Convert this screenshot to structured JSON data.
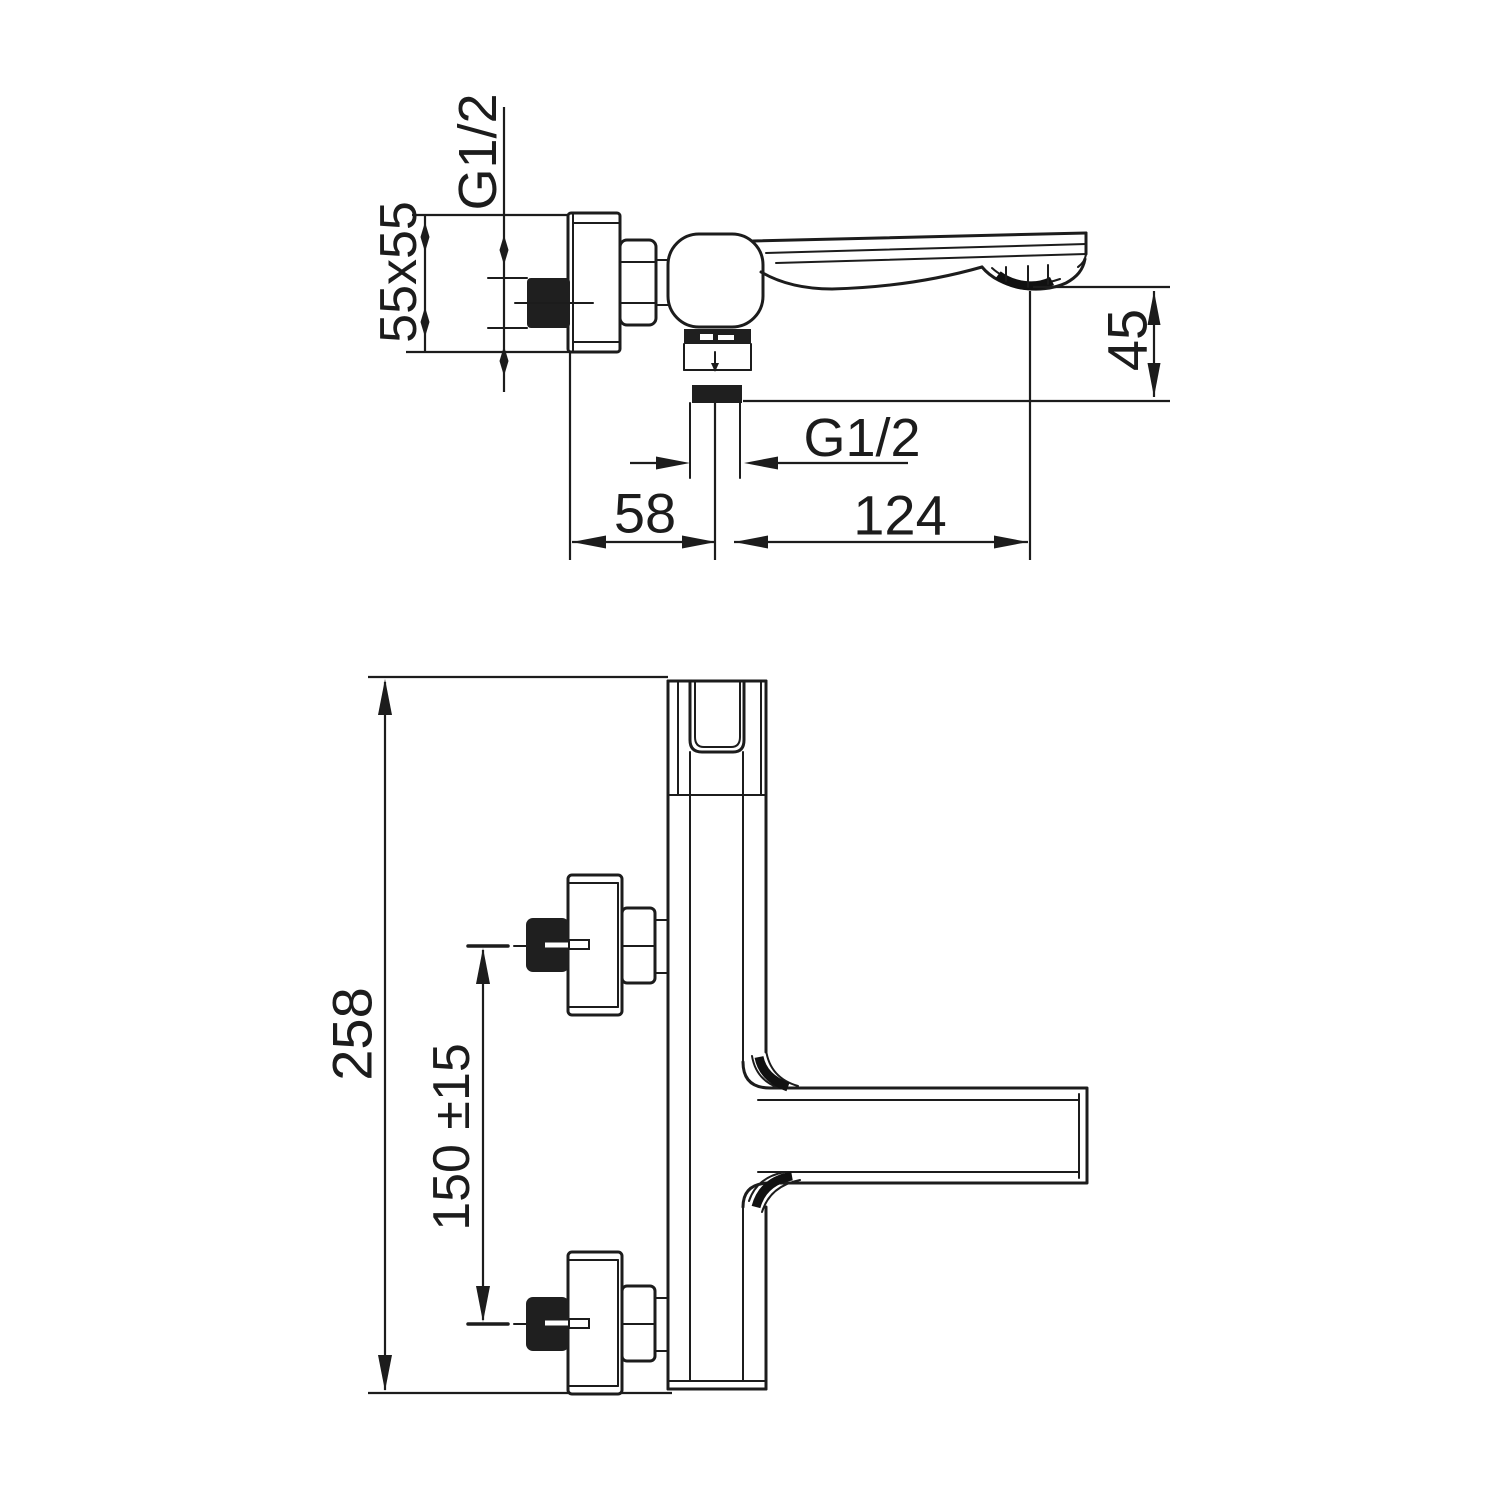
{
  "drawing": {
    "type": "technical-dimension-drawing",
    "subject": "wall-mounted single-lever bath mixer faucet, two orthographic views",
    "colors": {
      "background": "#ffffff",
      "line": "#1c1c1c",
      "solid_fill": "#1f1f1f"
    },
    "top_view": {
      "labels": {
        "inlet_thread": "G1/2",
        "escutcheon_size": "55x55",
        "spout_drop": "45",
        "outlet_thread": "G1/2",
        "wall_to_outlet": "58",
        "outlet_to_tip": "124"
      }
    },
    "front_view": {
      "labels": {
        "overall_height": "258",
        "connection_spacing": "150 ±15"
      }
    }
  }
}
